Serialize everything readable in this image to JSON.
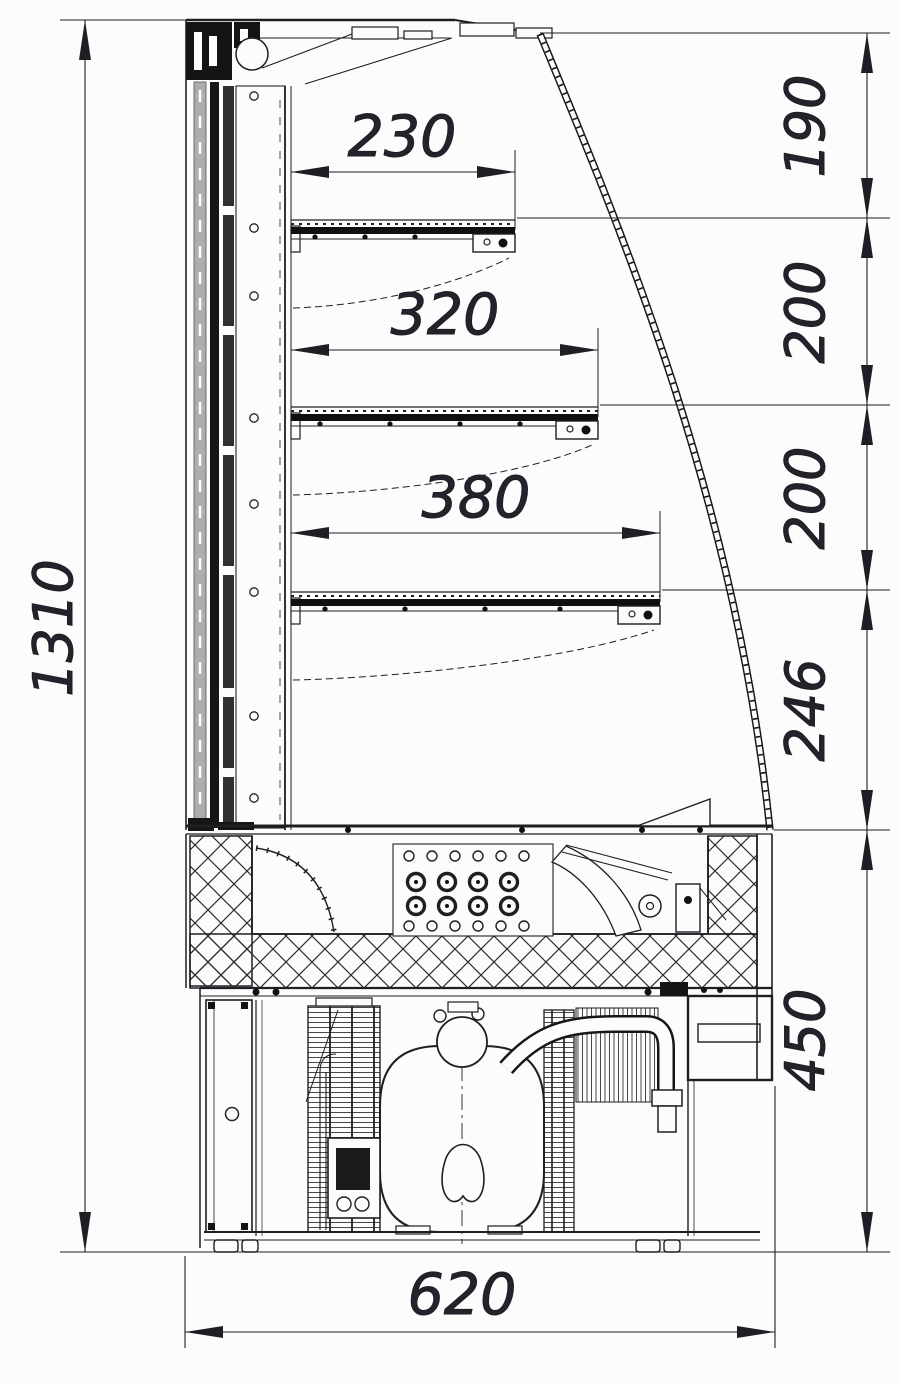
{
  "drawing": {
    "title": "Refrigerated display case side cross-section",
    "units": "mm",
    "overall": {
      "height": "1310",
      "depth": "620"
    },
    "vertical_chain": {
      "seg_190": "190",
      "seg_200a": "200",
      "seg_200b": "200",
      "seg_246": "246",
      "seg_450": "450"
    },
    "shelves": {
      "top": "230",
      "middle": "320",
      "bottom": "380"
    },
    "colors": {
      "ink": "#1e1e24",
      "background": "#fcfcfc",
      "insulation_gray": "#adadad"
    }
  }
}
